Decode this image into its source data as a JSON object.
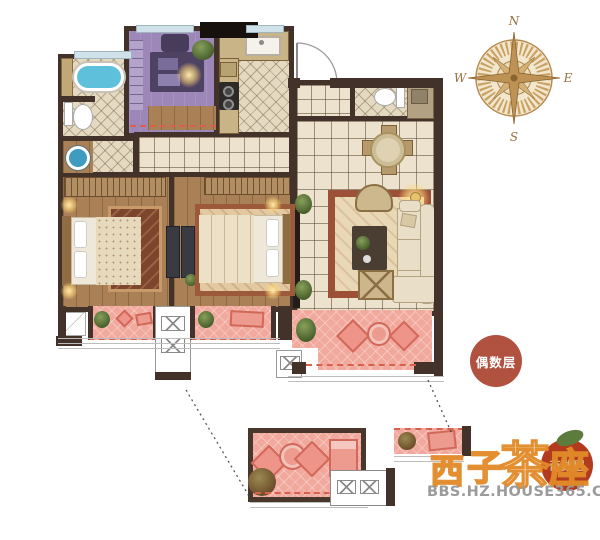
{
  "compass": {
    "n": "N",
    "e": "E",
    "s": "S",
    "w": "W"
  },
  "badges": {
    "even": {
      "label": "偶数层",
      "color": "#b15140"
    },
    "odd": {
      "label": "奇数层",
      "color": "#b23a1f"
    }
  },
  "watermark": {
    "chars": {
      "c1": "西",
      "c2": "子",
      "c3": "茶",
      "c4": "座"
    },
    "site": "BBS.HZ.HOUSE365.COM",
    "brand_color": "#e28a28"
  },
  "colors": {
    "wall": "#42322a",
    "tile": "#ece2cd",
    "wood_floor": "#aa8157",
    "purple_room": "#9d87b8",
    "balcony_pink": "#f1a99d",
    "balcony_accent": "#d9604f",
    "bathtub_blue": "#5fc0dc",
    "compass_tan": "#b68a4e"
  }
}
